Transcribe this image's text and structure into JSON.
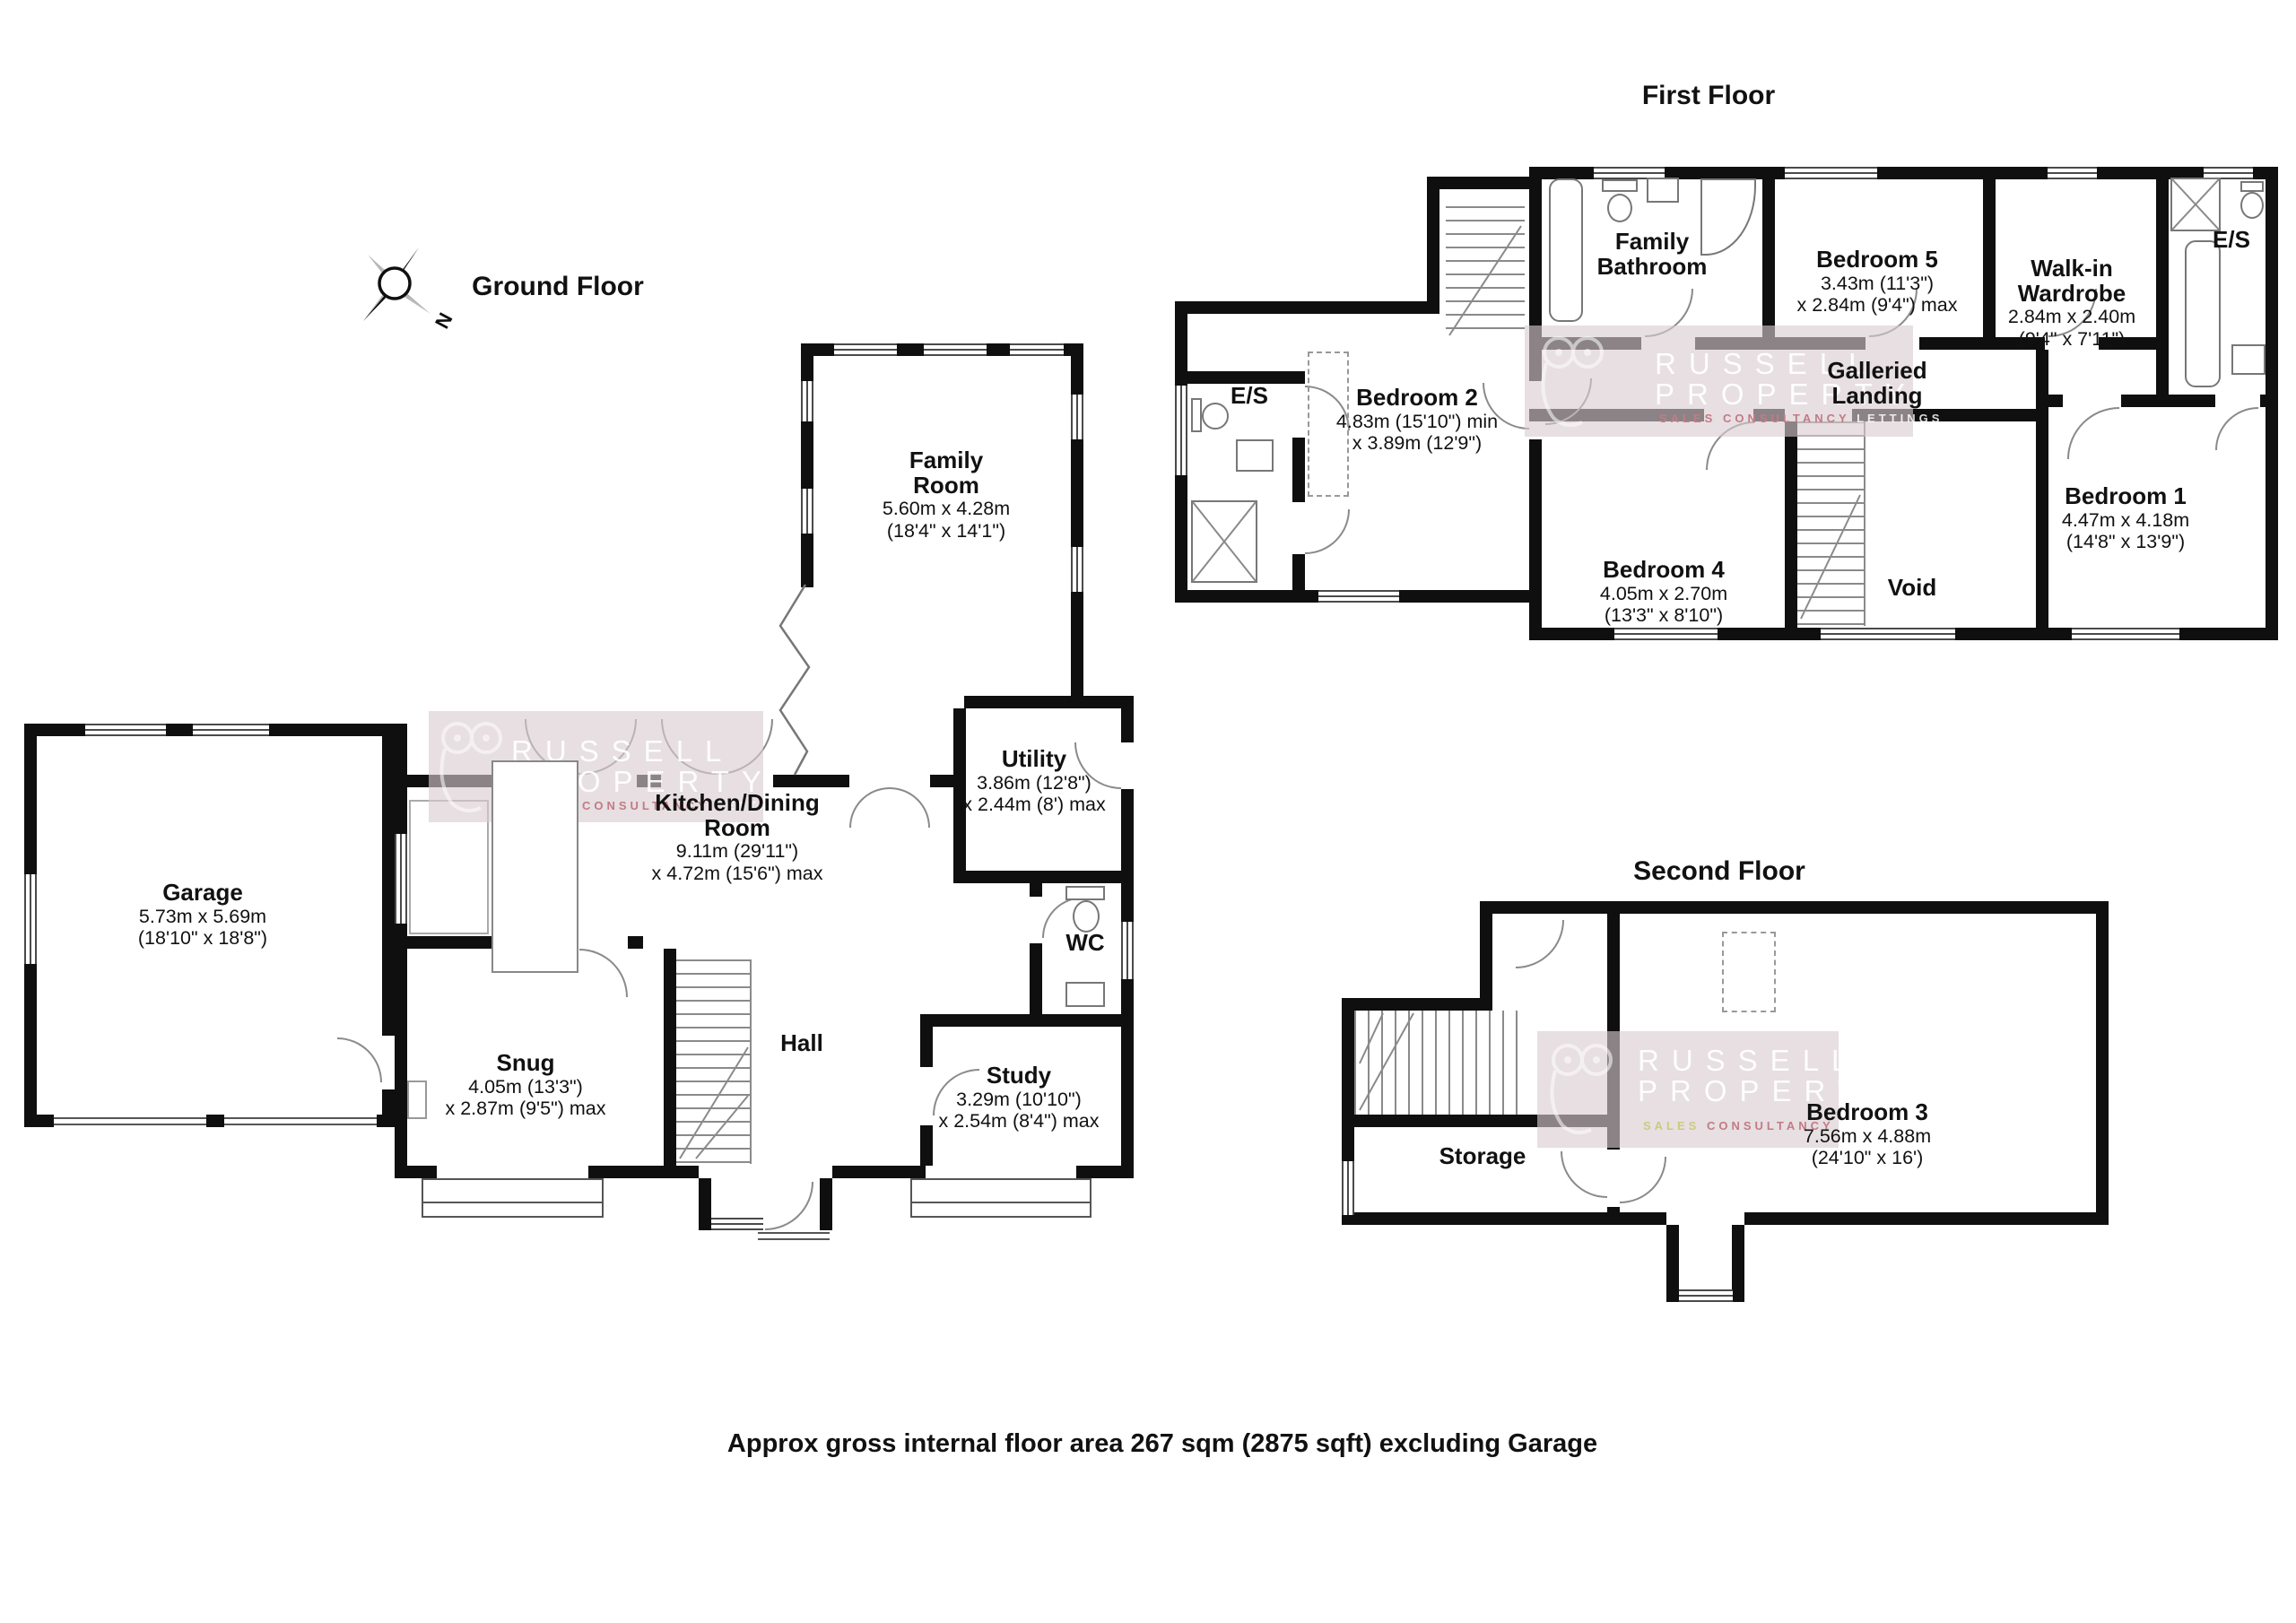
{
  "headings": {
    "ground_floor": "Ground Floor",
    "first_floor": "First Floor",
    "second_floor": "Second Floor"
  },
  "footer_text": "Approx gross internal floor area 267 sqm (2875 sqft) excluding Garage",
  "compass_label": "N",
  "watermark": {
    "brand_line1": "RUSSELL",
    "brand_line2": "PROPERTY",
    "tagline_sales": "SALES",
    "tagline_consultancy": "CONSULTANCY",
    "tagline_lettings": "LETTINGS"
  },
  "colors": {
    "wall": "#0f0f0f",
    "watermark_band": "rgba(216,204,207,0.62)",
    "tagline_red": "#c27b87",
    "tagline_yellow": "#c9cc7d"
  },
  "rooms": {
    "ground": [
      {
        "key": "garage",
        "name": "Garage",
        "dim1": "5.73m x 5.69m",
        "dim2": "(18'10\" x 18'8\")"
      },
      {
        "key": "family_room",
        "name": "Family\nRoom",
        "dim1": "5.60m x 4.28m",
        "dim2": "(18'4\" x 14'1\")"
      },
      {
        "key": "kitchen_dining",
        "name": "Kitchen/Dining\nRoom",
        "dim1": "9.11m (29'11\")",
        "dim2": "x 4.72m (15'6\") max"
      },
      {
        "key": "utility",
        "name": "Utility",
        "dim1": "3.86m (12'8\")",
        "dim2": "x 2.44m (8') max"
      },
      {
        "key": "wc",
        "name": "WC"
      },
      {
        "key": "snug",
        "name": "Snug",
        "dim1": "4.05m (13'3\")",
        "dim2": "x 2.87m (9'5\") max"
      },
      {
        "key": "hall",
        "name": "Hall"
      },
      {
        "key": "study",
        "name": "Study",
        "dim1": "3.29m (10'10\")",
        "dim2": "x 2.54m (8'4\") max"
      }
    ],
    "first": [
      {
        "key": "family_bathroom",
        "name": "Family\nBathroom"
      },
      {
        "key": "bedroom_5",
        "name": "Bedroom 5",
        "dim1": "3.43m (11'3\")",
        "dim2": "x 2.84m (9'4\") max"
      },
      {
        "key": "walk_in_wardrobe",
        "name": "Walk-in\nWardrobe",
        "dim1": "2.84m x 2.40m",
        "dim2": "(9'4\" x 7'11\")"
      },
      {
        "key": "es_right",
        "name": "E/S"
      },
      {
        "key": "es_left",
        "name": "E/S"
      },
      {
        "key": "bedroom_2",
        "name": "Bedroom 2",
        "dim1": "4.83m (15'10\") min",
        "dim2": "x 3.89m (12'9\")"
      },
      {
        "key": "galleried_landing",
        "name": "Galleried\nLanding"
      },
      {
        "key": "bedroom_4",
        "name": "Bedroom 4",
        "dim1": "4.05m x 2.70m",
        "dim2": "(13'3\" x 8'10\")"
      },
      {
        "key": "void",
        "name": "Void"
      },
      {
        "key": "bedroom_1",
        "name": "Bedroom 1",
        "dim1": "4.47m x 4.18m",
        "dim2": "(14'8\" x 13'9\")"
      }
    ],
    "second": [
      {
        "key": "bedroom_3",
        "name": "Bedroom 3",
        "dim1": "7.56m x 4.88m",
        "dim2": "(24'10\" x 16')"
      },
      {
        "key": "storage",
        "name": "Storage"
      }
    ]
  }
}
